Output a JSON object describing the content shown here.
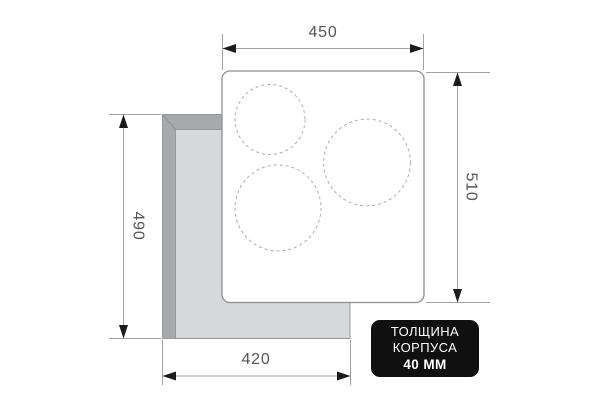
{
  "dimensions": {
    "top_width": "450",
    "right_height": "510",
    "left_height": "490",
    "bottom_width": "420"
  },
  "badge": {
    "line1": "ТОЛЩИНА",
    "line2": "КОРПУСА",
    "line3": "40 ММ"
  },
  "burners": [
    {
      "name": "top-left",
      "cx": 270,
      "cy": 119.5,
      "r": 35
    },
    {
      "name": "right",
      "cx": 367,
      "cy": 162.5,
      "r": 43.4
    },
    {
      "name": "bottom-left",
      "cx": 278,
      "cy": 208,
      "r": 43
    }
  ],
  "colors": {
    "background": "#ffffff",
    "badge_background": "#101010",
    "badge_text": "#ffffff",
    "dimension_line": "#a0a2a5",
    "dimension_text": "#55565a",
    "arrowhead": "#1b1b1b",
    "panel_border": "#8d8f92",
    "burner_outline": "#aaacae",
    "cutout_wall": "#a7a9ac",
    "cutout_opening": "#d7d8da"
  }
}
